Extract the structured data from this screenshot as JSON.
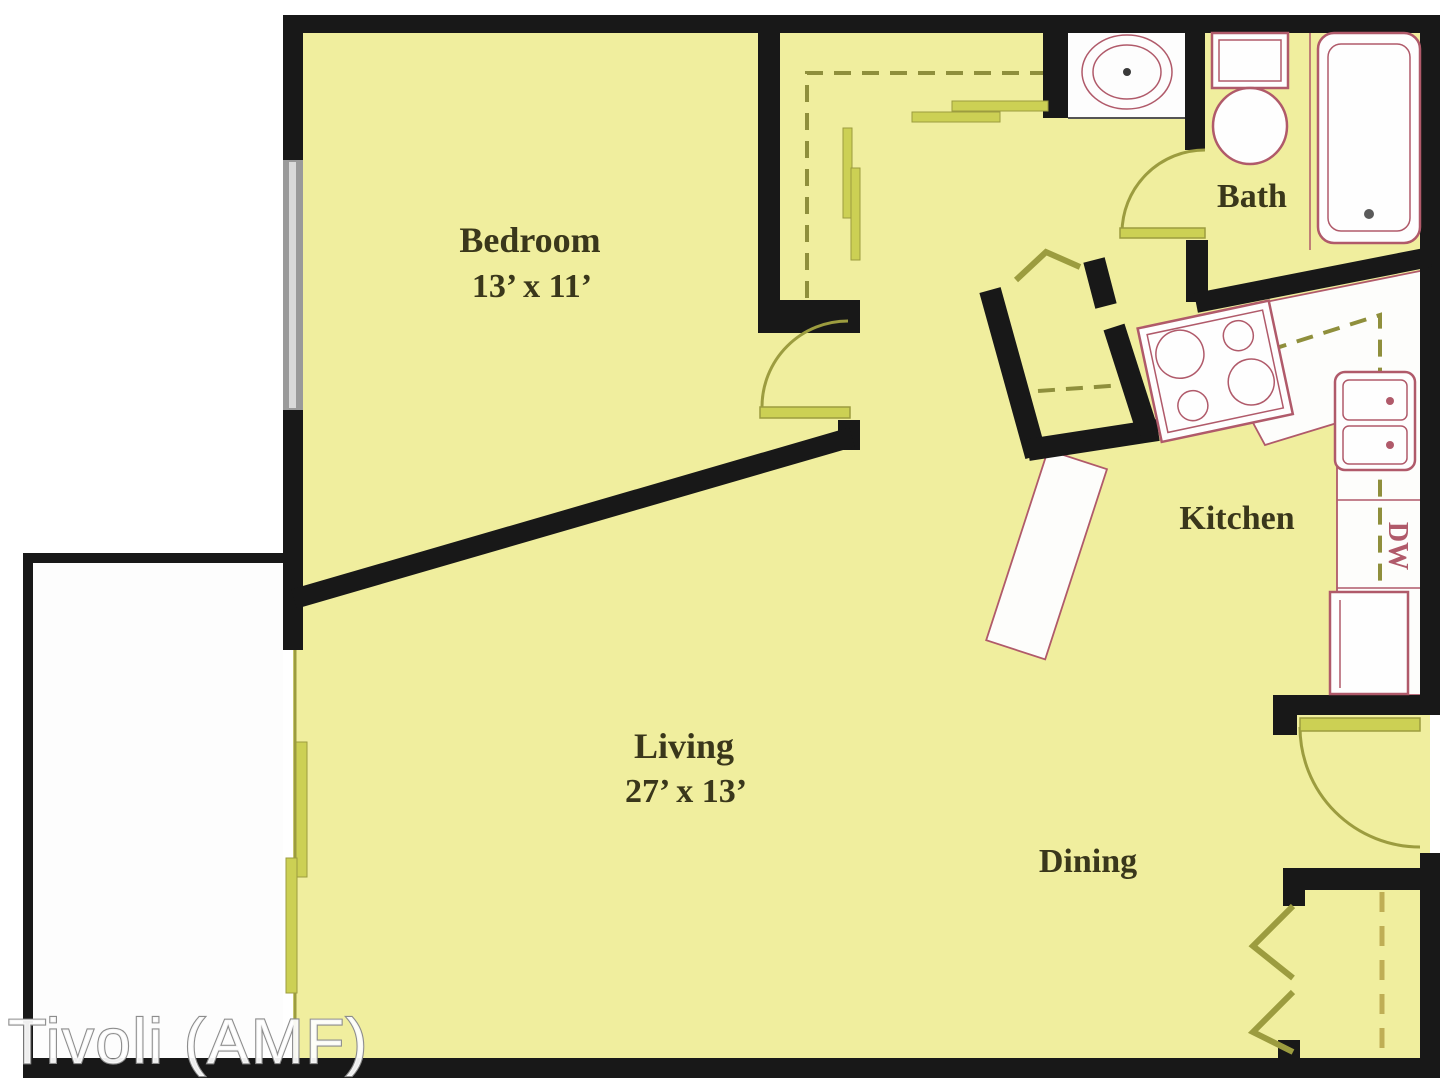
{
  "watermark_text": "Tivoli (AMF)",
  "rooms": {
    "bedroom": {
      "name": "Bedroom",
      "dimensions": "13’ x 11’"
    },
    "living": {
      "name": "Living",
      "dimensions": "27’ x 13’"
    },
    "dining": {
      "name": "Dining"
    },
    "kitchen": {
      "name": "Kitchen"
    },
    "bath": {
      "name": "Bath"
    }
  },
  "fixtures": {
    "dishwasher_abbrev": "DW",
    "icons": [
      "bathtub-icon",
      "toilet-icon",
      "vanity-sink-icon",
      "range-icon",
      "double-sink-icon",
      "refrigerator-icon",
      "window-icon",
      "sliding-door-icon",
      "bifold-door-icon",
      "door-swing-icon",
      "closet-rod-icon"
    ]
  },
  "colors": {
    "floor": "#f0ee9e",
    "wall": "#181818",
    "fixture": "#b05a6a",
    "door": "#9c9c3f",
    "door-bright": "#ccd054",
    "dash": "#8f8f3c",
    "closet-dash": "#bfae55",
    "label": "#3a371b",
    "window": "#9a9a9a",
    "watermark-stroke": "#8d8d8d"
  }
}
